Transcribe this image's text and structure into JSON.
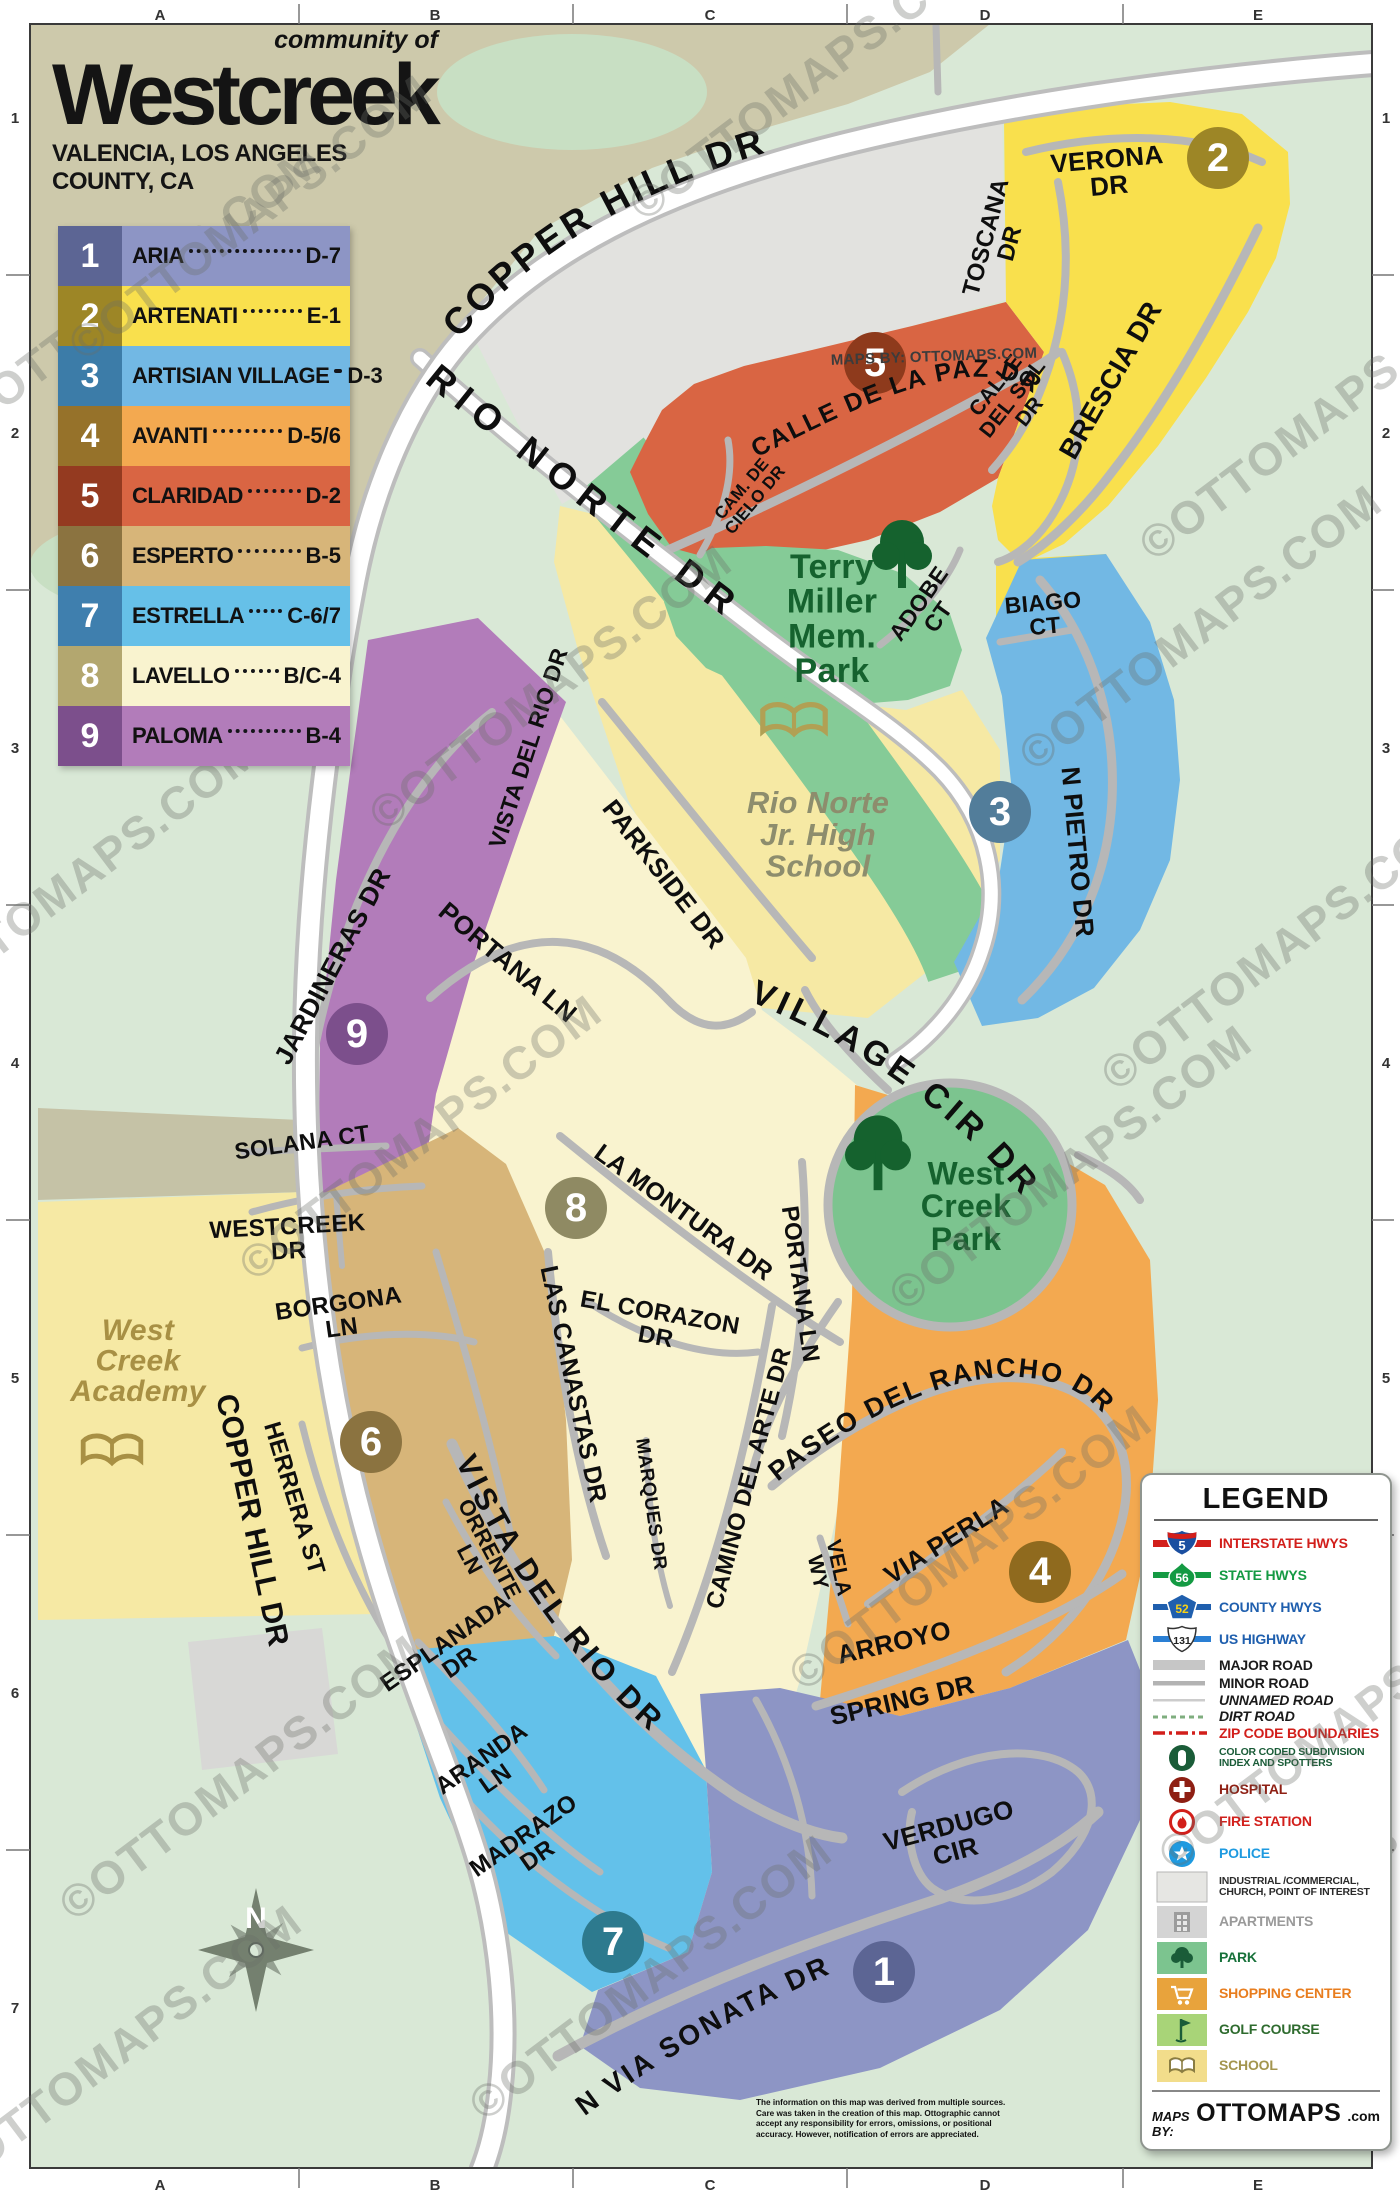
{
  "header": {
    "community_of": "community of",
    "title": "Westcreek",
    "subtitle": "VALENCIA, LOS ANGELES COUNTY, CA"
  },
  "index": {
    "rows": [
      {
        "num": "1",
        "name": "ARIA",
        "grid": "D-7",
        "row_bg": "#8d95c5",
        "num_bg": "#5c6594"
      },
      {
        "num": "2",
        "name": "ARTENATI",
        "grid": "E-1",
        "row_bg": "#f9e04d",
        "num_bg": "#9d8626"
      },
      {
        "num": "3",
        "name": "ARTISIAN VILLAGE",
        "grid": "D-3",
        "row_bg": "#72b8e4",
        "num_bg": "#3c7ca8"
      },
      {
        "num": "4",
        "name": "AVANTI",
        "grid": "D-5/6",
        "row_bg": "#f3a950",
        "num_bg": "#96722a"
      },
      {
        "num": "5",
        "name": "CLARIDAD",
        "grid": "D-2",
        "row_bg": "#d96543",
        "num_bg": "#943a20"
      },
      {
        "num": "6",
        "name": "ESPERTO",
        "grid": "B-5",
        "row_bg": "#d7b579",
        "num_bg": "#8b7340"
      },
      {
        "num": "7",
        "name": "ESTRELLA",
        "grid": "C-6/7",
        "row_bg": "#66c0e8",
        "num_bg": "#3f7fae"
      },
      {
        "num": "8",
        "name": "LAVELLO",
        "grid": "B/C-4",
        "row_bg": "#f9f3cf",
        "num_bg": "#b3a76f"
      },
      {
        "num": "9",
        "name": "PALOMA",
        "grid": "B-4",
        "row_bg": "#b27cba",
        "num_bg": "#7c4f8c"
      }
    ]
  },
  "grid": {
    "cols": [
      "A",
      "B",
      "C",
      "D",
      "E"
    ],
    "rows": [
      "1",
      "2",
      "3",
      "4",
      "5",
      "6",
      "7"
    ],
    "col_x": [
      160,
      435,
      710,
      985,
      1258
    ],
    "row_y": [
      118,
      433,
      748,
      1063,
      1378,
      1693,
      2008
    ],
    "col_ticks": [
      299,
      573,
      847,
      1123
    ],
    "row_ticks": [
      275,
      590,
      905,
      1220,
      1535,
      1850
    ]
  },
  "map": {
    "watermark": "©OTTOMAPS.COM",
    "labels": [
      {
        "l": [
          "VERONA",
          "DR"
        ],
        "x": 1108,
        "y": 172,
        "r": -5,
        "s": 26
      },
      {
        "l": [
          "TOSCANA",
          "DR"
        ],
        "x": 997,
        "y": 240,
        "r": -75,
        "s": 24
      },
      {
        "l": [
          "CALLE",
          "DEL SOL",
          "DR"
        ],
        "x": 1012,
        "y": 398,
        "r": -52,
        "s": 21
      },
      {
        "l": [
          "BRESCIA DR"
        ],
        "x": 1110,
        "y": 380,
        "r": -60,
        "s": 28
      },
      {
        "l": [
          "CAM. DE",
          "CIELO DR"
        ],
        "x": 748,
        "y": 494,
        "r": -50,
        "s": 17
      },
      {
        "l": [
          "ADOBE",
          "CT"
        ],
        "x": 928,
        "y": 610,
        "r": -55,
        "s": 23
      },
      {
        "l": [
          "BIAGO",
          "CT"
        ],
        "x": 1044,
        "y": 614,
        "r": -5,
        "s": 23
      },
      {
        "l": [
          "N PIETRO DR"
        ],
        "x": 1078,
        "y": 852,
        "r": 85,
        "s": 26
      },
      {
        "l": [
          "MAPS BY: OTTOMAPS.COM"
        ],
        "x": 934,
        "y": 356,
        "r": -2,
        "s": 15,
        "c": "#3c3c3c"
      },
      {
        "l": [
          "VISTA DEL RIO DR"
        ],
        "x": 528,
        "y": 748,
        "r": -72,
        "s": 23
      },
      {
        "l": [
          "PARKSIDE DR"
        ],
        "x": 664,
        "y": 874,
        "r": 52,
        "s": 26
      },
      {
        "l": [
          "PORTANA LN"
        ],
        "x": 508,
        "y": 962,
        "r": 40,
        "s": 26
      },
      {
        "l": [
          "JARDINERAS DR"
        ],
        "x": 332,
        "y": 966,
        "r": -62,
        "s": 26
      },
      {
        "l": [
          "SOLANA CT"
        ],
        "x": 302,
        "y": 1142,
        "r": -8,
        "s": 23
      },
      {
        "l": [
          "WESTCREEK",
          "DR"
        ],
        "x": 288,
        "y": 1238,
        "r": -3,
        "s": 24
      },
      {
        "l": [
          "BORGONA",
          "LN"
        ],
        "x": 340,
        "y": 1315,
        "r": -8,
        "s": 24
      },
      {
        "l": [
          "HERRERA ST"
        ],
        "x": 295,
        "y": 1498,
        "r": 73,
        "s": 24
      },
      {
        "l": [
          "ORRENTE",
          "LN"
        ],
        "x": 480,
        "y": 1554,
        "r": 62,
        "s": 22
      },
      {
        "l": [
          "LAS CANASTAS DR"
        ],
        "x": 574,
        "y": 1384,
        "r": 78,
        "s": 25
      },
      {
        "l": [
          "MARQUES DR"
        ],
        "x": 652,
        "y": 1504,
        "r": 82,
        "s": 19
      },
      {
        "l": [
          "EL CORAZON",
          "DR"
        ],
        "x": 658,
        "y": 1324,
        "r": 10,
        "s": 24
      },
      {
        "l": [
          "LA MONTURA DR"
        ],
        "x": 684,
        "y": 1212,
        "r": 36,
        "s": 25
      },
      {
        "l": [
          "PORTANA LN"
        ],
        "x": 801,
        "y": 1284,
        "r": 82,
        "s": 24
      },
      {
        "l": [
          "CAMINO DEL ARTE DR"
        ],
        "x": 748,
        "y": 1478,
        "r": -75,
        "s": 24
      },
      {
        "l": [
          "VIA PERLA"
        ],
        "x": 946,
        "y": 1540,
        "r": -32,
        "s": 26
      },
      {
        "l": [
          "VELA",
          "WY"
        ],
        "x": 829,
        "y": 1570,
        "r": 78,
        "s": 21
      },
      {
        "l": [
          "ARROYO"
        ],
        "x": 894,
        "y": 1642,
        "r": -13,
        "s": 26
      },
      {
        "l": [
          "SPRING DR"
        ],
        "x": 902,
        "y": 1700,
        "r": -13,
        "s": 26
      },
      {
        "l": [
          "VERDUGO",
          "CIR"
        ],
        "x": 952,
        "y": 1838,
        "r": -15,
        "s": 26
      },
      {
        "l": [
          "ESPLANADA",
          "DR"
        ],
        "x": 452,
        "y": 1652,
        "r": -35,
        "s": 24
      },
      {
        "l": [
          "ARANDA",
          "LN"
        ],
        "x": 488,
        "y": 1768,
        "r": -35,
        "s": 24
      },
      {
        "l": [
          "MADRAZO",
          "DR"
        ],
        "x": 530,
        "y": 1845,
        "r": -35,
        "s": 24
      },
      {
        "l": [
          "COPPER HILL DR"
        ],
        "x": 253,
        "y": 1520,
        "r": 78,
        "s": 30
      },
      {
        "l": [
          "Terry",
          "Miller",
          "Mem.",
          "Park"
        ],
        "x": 832,
        "y": 618,
        "r": 0,
        "s": 34,
        "c": "#15622e"
      },
      {
        "l": [
          "Rio Norte",
          "Jr. High",
          "School"
        ],
        "x": 818,
        "y": 834,
        "r": 0,
        "s": 31,
        "c": "#8d8d6d",
        "i": 1
      },
      {
        "l": [
          "West",
          "Creek",
          "Park"
        ],
        "x": 966,
        "y": 1206,
        "r": 0,
        "s": 32,
        "c": "#15622e"
      },
      {
        "l": [
          "West",
          "Creek",
          "Academy"
        ],
        "x": 138,
        "y": 1360,
        "r": 0,
        "s": 30,
        "c": "#a89044",
        "i": 1
      }
    ],
    "curved": [
      {
        "t": "COPPER HILL DR",
        "p": "cp1",
        "s": 37,
        "o": "2%",
        "ls": 4
      },
      {
        "t": "RIO NORTE DR",
        "p": "cp2",
        "s": 37,
        "o": "4%",
        "ls": 10
      },
      {
        "t": "VILLAGE CIR DR",
        "p": "cp3",
        "s": 34,
        "o": "2%",
        "ls": 5
      },
      {
        "t": "CALLE DE LA PAZ DR",
        "p": "cp4",
        "s": 25,
        "o": "2%",
        "ls": 2
      },
      {
        "t": "PASEO DEL RANCHO DR",
        "p": "cp5",
        "s": 27,
        "o": "2%",
        "ls": 2
      },
      {
        "t": "VISTA DEL RIO DR",
        "p": "cp6",
        "s": 31,
        "o": "4%",
        "ls": 4
      },
      {
        "t": "N VIA SONATA DR",
        "p": "cp7",
        "s": 28,
        "o": "4%",
        "ls": 3
      }
    ],
    "spotters": [
      {
        "n": "1",
        "x": 884,
        "y": 1972,
        "c": "#5c6594"
      },
      {
        "n": "2",
        "x": 1218,
        "y": 158,
        "c": "#9d8626"
      },
      {
        "n": "3",
        "x": 1000,
        "y": 812,
        "c": "#527d9a"
      },
      {
        "n": "4",
        "x": 1040,
        "y": 1572,
        "c": "#8f6a1e"
      },
      {
        "n": "5",
        "x": 875,
        "y": 363,
        "c": "#8e3a1c"
      },
      {
        "n": "6",
        "x": 371,
        "y": 1442,
        "c": "#8b7340"
      },
      {
        "n": "7",
        "x": 613,
        "y": 1942,
        "c": "#2d7a8e"
      },
      {
        "n": "8",
        "x": 576,
        "y": 1208,
        "c": "#8f8a63"
      },
      {
        "n": "9",
        "x": 357,
        "y": 1034,
        "c": "#7c4f8c"
      }
    ],
    "icons": [
      {
        "t": "tree",
        "x": 902,
        "y": 566,
        "k": 2.0,
        "c": "#15622e"
      },
      {
        "t": "tree",
        "x": 878,
        "y": 1166,
        "k": 2.2,
        "c": "#15622e"
      },
      {
        "t": "book",
        "x": 794,
        "y": 722,
        "k": 2.6,
        "c": "#b1a054"
      },
      {
        "t": "book",
        "x": 112,
        "y": 1452,
        "k": 2.4,
        "c": "#a89044"
      }
    ],
    "watermarks": [
      [
        820,
        90
      ],
      [
        1330,
        430
      ],
      [
        150,
        300
      ],
      [
        560,
        700
      ],
      [
        1210,
        640
      ],
      [
        88,
        890
      ],
      [
        1292,
        960
      ],
      [
        430,
        1150
      ],
      [
        1080,
        1180
      ],
      [
        250,
        1790
      ],
      [
        660,
        1990
      ],
      [
        1330,
        1900
      ],
      [
        130,
        2060
      ],
      [
        980,
        1560
      ]
    ]
  },
  "legend": {
    "title": "LEGEND",
    "items": [
      {
        "icon": "interstate",
        "num": "5",
        "label": "INTERSTATE HWYS",
        "color": "#d21f1b"
      },
      {
        "icon": "state",
        "num": "56",
        "label": "STATE HWYS",
        "color": "#149a43"
      },
      {
        "icon": "county",
        "num": "52",
        "label": "COUNTY HWYS",
        "color": "#1f5fae"
      },
      {
        "icon": "us",
        "num": "131",
        "label": "US HIGHWAY",
        "color": "#1f5fae"
      },
      {
        "icon": "major-road",
        "label": "MAJOR ROAD",
        "color": "#1a1a1a"
      },
      {
        "icon": "minor-road",
        "label": "MINOR ROAD",
        "color": "#1a1a1a"
      },
      {
        "icon": "unnamed-road",
        "label": "UNNAMED ROAD",
        "color": "#1a1a1a",
        "italic": true
      },
      {
        "icon": "dirt-road",
        "label": "DIRT ROAD",
        "color": "#1a1a1a",
        "italic": true
      },
      {
        "icon": "zip",
        "label": "ZIP CODE BOUNDARIES",
        "color": "#d21f1b"
      },
      {
        "icon": "spotter",
        "label": "COLOR CODED SUBDIVISION\nINDEX AND SPOTTERS",
        "color": "#1a5c38"
      },
      {
        "icon": "hospital",
        "label": "HOSPITAL",
        "color": "#8e1f13"
      },
      {
        "icon": "fire",
        "label": "FIRE STATION",
        "color": "#d21f1b"
      },
      {
        "icon": "police",
        "label": "POLICE",
        "color": "#1e9ae0"
      },
      {
        "icon": "industrial",
        "label": "INDUSTRIAL /COMMERCIAL,\nCHURCH, POINT OF INTEREST",
        "color": "#2b2b2b"
      },
      {
        "icon": "apartments",
        "label": "APARTMENTS",
        "color": "#9a9a9a"
      },
      {
        "icon": "park",
        "label": "PARK",
        "color": "#17713a"
      },
      {
        "icon": "shopping",
        "label": "SHOPPING CENTER",
        "color": "#e87d1e"
      },
      {
        "icon": "golf",
        "label": "GOLF COURSE",
        "color": "#2e6b2e"
      },
      {
        "icon": "school",
        "label": "SCHOOL",
        "color": "#a3954e"
      }
    ],
    "credit_prefix": "MAPS BY:",
    "credit_brand": "OTTOMAPS",
    "credit_suffix": ".com"
  },
  "compass": {
    "letter": "N"
  },
  "disclaimer": "The information on this map was derived from multiple sources. Care was taken in the creation of this map. Ottographic cannot accept any responsibility for errors, omissions, or positional accuracy. However, notification of errors are appreciated."
}
